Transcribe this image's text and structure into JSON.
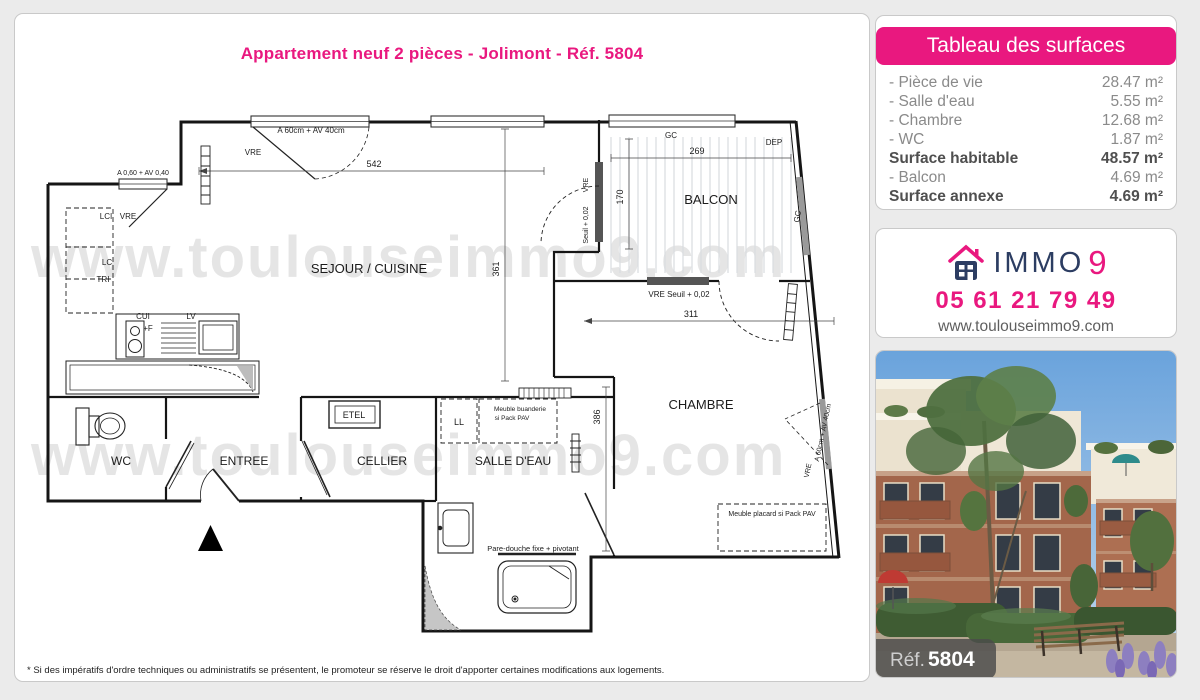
{
  "page": {
    "title": "Appartement neuf 2 pièces - Jolimont - Réf. 5804",
    "watermark": "www.toulouseimmo9.com",
    "disclaimer": "* Si des impératifs d'ordre techniques ou administratifs se présentent, le promoteur se réserve le droit d'apporter certaines modifications aux logements."
  },
  "colors": {
    "pink": "#e9187f",
    "navy": "#2c3d62",
    "page_bg": "#ebebeb",
    "muted_text": "#8a8a8a"
  },
  "surfaces": {
    "header": "Tableau des surfaces",
    "rows": [
      {
        "label": "- Pièce de vie",
        "value": "28.47 m²",
        "bold": false
      },
      {
        "label": "- Salle d'eau",
        "value": "5.55 m²",
        "bold": false
      },
      {
        "label": "- Chambre",
        "value": "12.68 m²",
        "bold": false
      },
      {
        "label": "- WC",
        "value": "1.87 m²",
        "bold": false
      },
      {
        "label": "Surface habitable",
        "value": "48.57 m²",
        "bold": true
      },
      {
        "label": "- Balcon",
        "value": "4.69 m²",
        "bold": false
      },
      {
        "label": "Surface annexe",
        "value": "4.69 m²",
        "bold": true
      }
    ]
  },
  "agency": {
    "brand": "IMMO",
    "brand_digit": "9",
    "phone": "05 61 21 79 49",
    "website": "www.toulouseimmo9.com"
  },
  "photo": {
    "ref_label": "Réf.",
    "ref_number": "5804"
  },
  "plan": {
    "labels": [
      {
        "t": "A 60cm + AV 40cm",
        "x": 272,
        "y": 26,
        "s": 8
      },
      {
        "t": "VRE",
        "x": 214,
        "y": 48,
        "s": 8
      },
      {
        "t": "542",
        "x": 335,
        "y": 60,
        "s": 9
      },
      {
        "t": "A 0,60 + AV 0,40",
        "x": 104,
        "y": 68,
        "s": 7
      },
      {
        "t": "LCI",
        "x": 67,
        "y": 112,
        "s": 8
      },
      {
        "t": "VRE",
        "x": 89,
        "y": 112,
        "s": 8
      },
      {
        "t": "LC",
        "x": 68,
        "y": 158,
        "s": 8
      },
      {
        "t": "TRI",
        "x": 64,
        "y": 175,
        "s": 8
      },
      {
        "t": "SEJOUR / CUISINE",
        "x": 330,
        "y": 166,
        "s": 13
      },
      {
        "t": "CUI",
        "x": 104,
        "y": 212,
        "s": 8
      },
      {
        "t": "+F",
        "x": 109,
        "y": 224,
        "s": 8
      },
      {
        "t": "LV",
        "x": 152,
        "y": 212,
        "s": 8
      },
      {
        "t": "GC",
        "x": 632,
        "y": 31,
        "s": 8
      },
      {
        "t": "DEP",
        "x": 735,
        "y": 38,
        "s": 8
      },
      {
        "t": "269",
        "x": 658,
        "y": 47,
        "s": 9
      },
      {
        "t": "170",
        "x": 584,
        "y": 90,
        "s": 9,
        "r": -90
      },
      {
        "t": "BALCON",
        "x": 672,
        "y": 97,
        "s": 13
      },
      {
        "t": "GC",
        "x": 761,
        "y": 110,
        "s": 8,
        "r": -80
      },
      {
        "t": "VRE",
        "x": 549,
        "y": 78,
        "s": 7,
        "r": -90
      },
      {
        "t": "Seuil + 0,02",
        "x": 549,
        "y": 118,
        "s": 7,
        "r": -90
      },
      {
        "t": "VRE  Seuil + 0,02",
        "x": 640,
        "y": 190,
        "s": 8
      },
      {
        "t": "311",
        "x": 652,
        "y": 210,
        "s": 9
      },
      {
        "t": "361",
        "x": 460,
        "y": 162,
        "s": 9,
        "r": -90
      },
      {
        "t": "CHAMBRE",
        "x": 662,
        "y": 302,
        "s": 13
      },
      {
        "t": "386",
        "x": 561,
        "y": 310,
        "s": 9,
        "r": -90
      },
      {
        "t": "Meuble placard si Pack PAV",
        "x": 733,
        "y": 409,
        "s": 7
      },
      {
        "t": "WC",
        "x": 82,
        "y": 358,
        "s": 12
      },
      {
        "t": "ENTREE",
        "x": 205,
        "y": 358,
        "s": 12
      },
      {
        "t": "CELLIER",
        "x": 343,
        "y": 358,
        "s": 12
      },
      {
        "t": "SALLE D'EAU",
        "x": 474,
        "y": 358,
        "s": 12
      },
      {
        "t": "ETEL",
        "x": 315,
        "y": 311,
        "s": 9
      },
      {
        "t": "LL",
        "x": 420,
        "y": 318,
        "s": 9
      },
      {
        "t": "Meuble buanderie",
        "x": 481,
        "y": 304,
        "s": 6.5
      },
      {
        "t": "si Pack PAV",
        "x": 473,
        "y": 313,
        "s": 6.5
      },
      {
        "t": "Pare-douche fixe + pivotant",
        "x": 494,
        "y": 444,
        "s": 7.5
      },
      {
        "t": "A 60cm + AV 40cm",
        "x": 786,
        "y": 326,
        "s": 7,
        "r": -78
      },
      {
        "t": "VRE",
        "x": 771,
        "y": 364,
        "s": 7,
        "r": -78
      }
    ]
  }
}
